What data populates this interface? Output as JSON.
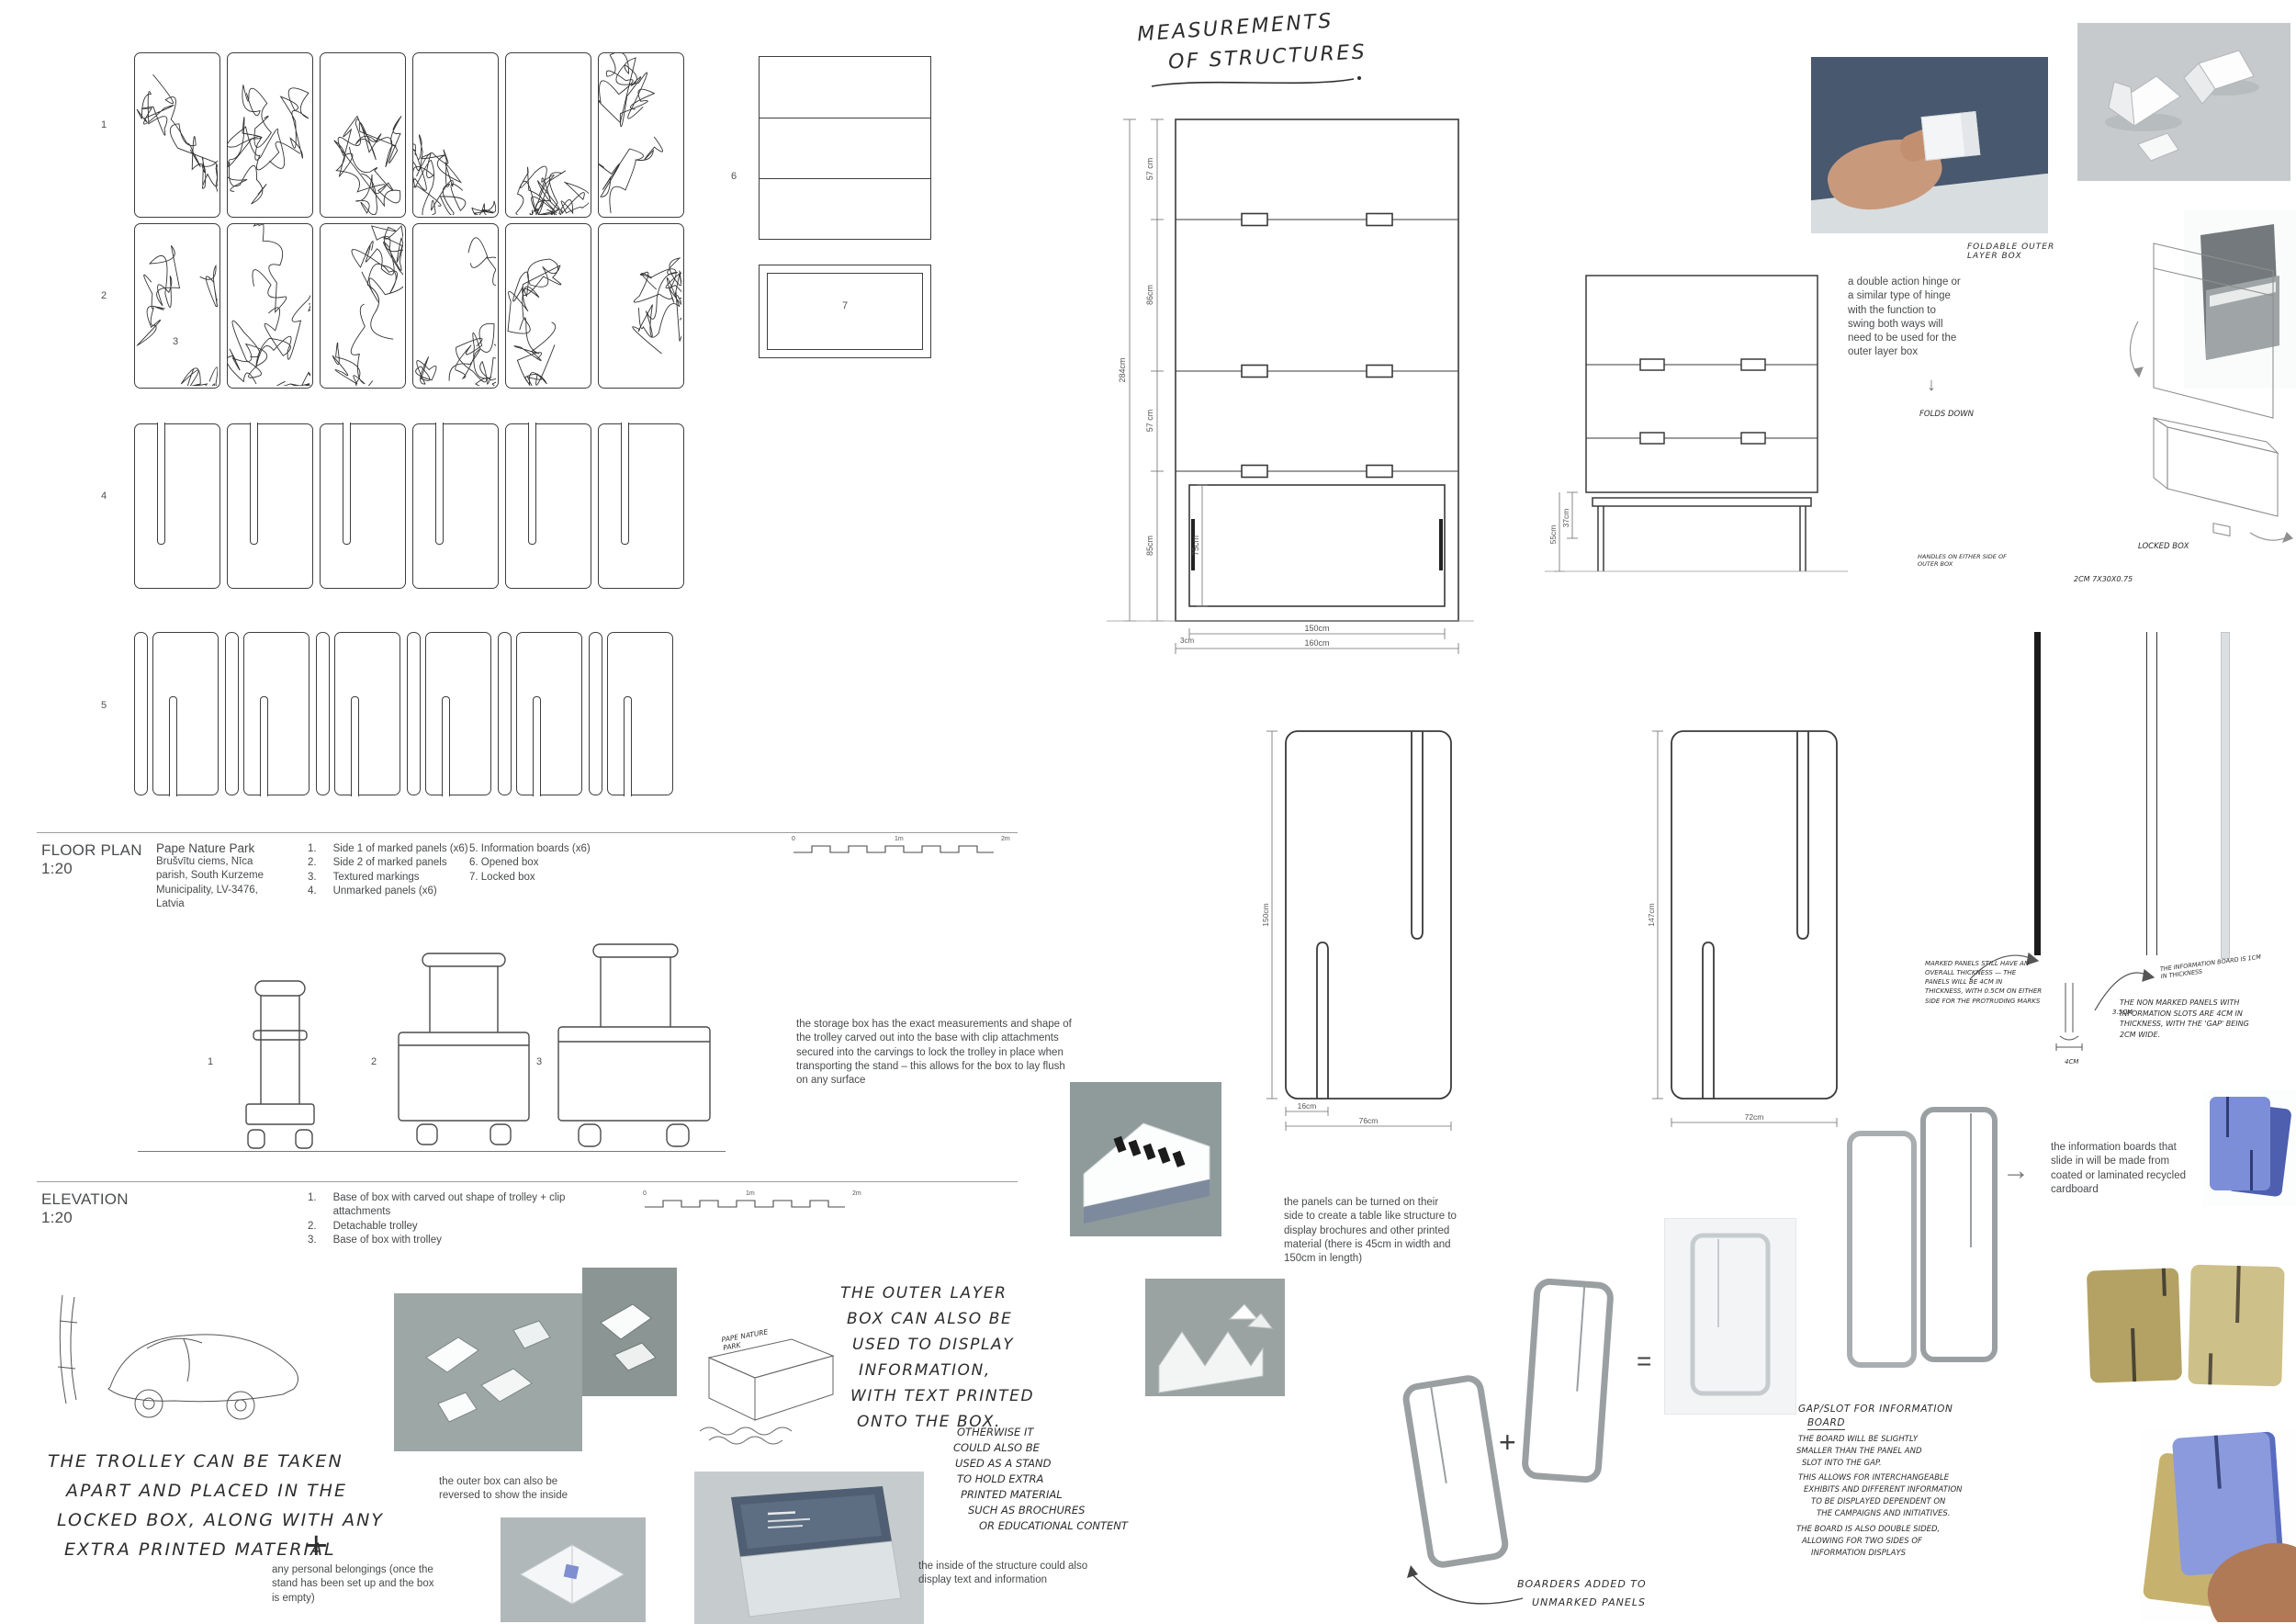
{
  "labels": {
    "row1": "1",
    "row2": "2",
    "texture": "3",
    "row4": "4",
    "row5": "5",
    "opened_box": "6",
    "locked_box": "7",
    "elev1": "1",
    "elev2": "2",
    "elev3": "3"
  },
  "floor_plan": {
    "title": "FLOOR PLAN",
    "scale": "1:20",
    "site_name": "Pape Nature Park",
    "address": [
      "Brušvītu ciems, Nīca",
      "parish, South Kurzeme",
      "Municipality, LV-3476,",
      "Latvia"
    ],
    "legend_a_nums": [
      "1.",
      "2.",
      "3.",
      "4."
    ],
    "legend_a": [
      "Side 1 of marked panels (x6)",
      "Side 2 of marked panels",
      "Textured markings",
      "Unmarked panels (x6)"
    ],
    "legend_b": [
      "5. Information boards (x6)",
      "6. Opened box",
      "7. Locked box"
    ],
    "scale_0": "0",
    "scale_1": "1m",
    "scale_2": "2m"
  },
  "elevation": {
    "title": "ELEVATION",
    "scale": "1:20",
    "legend_nums": [
      "1.",
      "2.",
      "3."
    ],
    "legend": [
      "Base of box with carved out shape of trolley + clip attachments",
      "Detachable trolley",
      "Base of box with trolley"
    ],
    "scale_0": "0",
    "scale_1": "1m",
    "scale_2": "2m",
    "storage_note": "the storage box has the exact measurements and shape of the trolley carved out into the base with clip attachments secured into the carvings to lock the trolley in place when transporting the stand – this allows for the box to lay flush on any surface"
  },
  "measurements": {
    "title1": "MEASUREMENTS",
    "title2": "OF STRUCTURES",
    "s1_seg": [
      "57 cm",
      "86cm",
      "57 cm",
      "85cm"
    ],
    "s1_inner": "75cm",
    "s1_total": "284cm",
    "s1_wi": "150cm",
    "s1_wo": "160cm",
    "s1_off": "3cm",
    "s2_d1": "37cm",
    "s2_d2": "55cm",
    "pl_h": "150cm",
    "pl_slot": "16cm",
    "pl_w": "76cm",
    "pr_h": "147cm",
    "pr_w": "72cm"
  },
  "hinge": {
    "label": "FOLDABLE OUTER LAYER BOX",
    "note": "a double action hinge or a similar type of hinge with the function to swing both ways will need to be used for the outer layer box",
    "arrow": "↓",
    "folds": "FOLDS DOWN",
    "locked": "LOCKED BOX",
    "handles": "HANDLES ON EITHER SIDE OF OUTER BOX",
    "dims": "2CM 7X30X0.75"
  },
  "thickness": {
    "marked": "MARKED PANELS STILL HAVE AN OVERALL THICKNESS — THE PANELS WILL BE 4CM IN THICKNESS, WITH 0.5CM ON EITHER SIDE FOR THE PROTRUDING MARKS",
    "nonmarked": "THE NON MARKED PANELS WITH INFORMATION SLOTS ARE 4CM IN THICKNESS, WITH THE 'GAP' BEING 2CM WIDE.",
    "board": "THE INFORMATION BOARD IS 1CM IN THICKNESS",
    "d1": "3.5CM",
    "d2": "4CM"
  },
  "trolley": {
    "l0": "THE TROLLEY CAN BE TAKEN",
    "l1": "APART AND PLACED IN THE",
    "l2": "LOCKED BOX, ALONG WITH ANY",
    "l3": "EXTRA PRINTED MATERIAL",
    "plus": "+",
    "belongings": "any personal belongings (once the stand has been set up and the box is empty)"
  },
  "outer_box": {
    "reversed": "the outer box can also be reversed to show the inside",
    "display": [
      "THE OUTER LAYER",
      "BOX CAN ALSO BE",
      "USED TO DISPLAY",
      "INFORMATION,",
      "WITH TEXT PRINTED",
      "ONTO THE BOX."
    ],
    "otherwise": [
      "OTHERWISE IT",
      "COULD ALSO BE",
      "USED AS A STAND",
      "TO HOLD EXTRA",
      "PRINTED MATERIAL",
      "SUCH AS BROCHURES",
      "OR EDUCATIONAL CONTENT"
    ],
    "inside": "the inside of the structure could also display text and information",
    "sketch_label": "PAPE NATURE PARK"
  },
  "panels_use": {
    "table_note": "the panels can be turned on their side to create a table like structure to display brochures and other printed material (there is 45cm in width and 150cm in length)",
    "boards_note": "the information boards that slide in will be made from coated or laminated recycled cardboard",
    "plus": "+",
    "equals": "=",
    "arrow": "→",
    "boarders1": "BOARDERS ADDED TO",
    "boarders2": "UNMARKED PANELS"
  },
  "gap_slot": {
    "t1": "GAP/SLOT FOR INFORMATION",
    "t2": "BOARD",
    "body": [
      "THE BOARD WILL BE SLIGHTLY",
      "SMALLER THAN THE PANEL AND",
      "SLOT INTO THE GAP.",
      "THIS ALLOWS FOR INTERCHANGEABLE",
      "EXHIBITS AND DIFFERENT INFORMATION",
      "TO BE DISPLAYED DEPENDENT ON",
      "THE CAMPAIGNS AND INITIATIVES.",
      "THE BOARD IS ALSO DOUBLE SIDED,",
      "ALLOWING FOR TWO SIDES OF",
      "INFORMATION DISPLAYS"
    ]
  }
}
